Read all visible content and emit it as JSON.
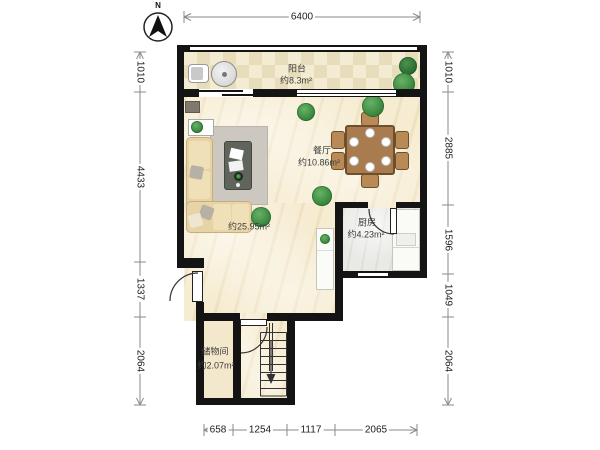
{
  "compass": {
    "label": "N"
  },
  "rooms": {
    "balcony": {
      "name": "阳台",
      "area": "约8.3m²"
    },
    "living": {
      "area": "约25.95m²"
    },
    "dining": {
      "name": "餐厅",
      "area": "约10.86m²"
    },
    "kitchen": {
      "name": "厨房",
      "area": "约4.23m²"
    },
    "storage": {
      "name": "储物间",
      "area": "约2.07m²"
    }
  },
  "dimensions": {
    "top": [
      "6400"
    ],
    "left": [
      "1010",
      "4433",
      "1337",
      "2064"
    ],
    "right": [
      "1010",
      "2885",
      "1596",
      "1049",
      "2064"
    ],
    "bottom": [
      "658",
      "1254",
      "1117",
      "2065"
    ]
  },
  "colors": {
    "wall": "#141414",
    "floor_main": "#f6ecd1",
    "floor_balcony": "#efe6c8",
    "floor_kitchen": "#e9e9e6",
    "plant_green": "#3c8a40",
    "sofa": "#e7d3a6",
    "dining_table": "#a87c4e",
    "rug": "#ccc8bf"
  }
}
